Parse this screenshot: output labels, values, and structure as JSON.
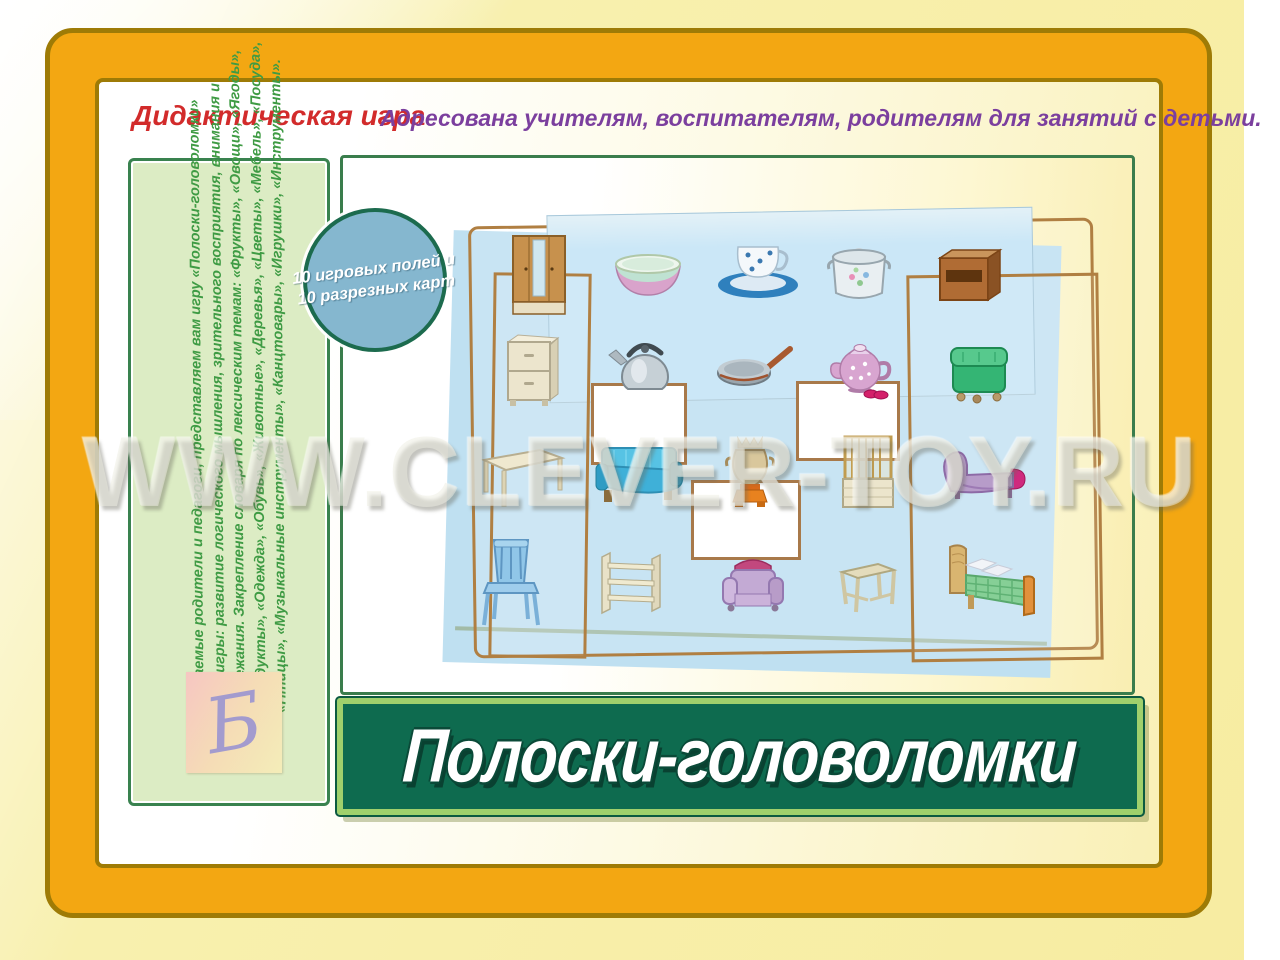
{
  "header": {
    "label": "Дидактическая игра",
    "audience": "Адресована учителям, воспитателям, родителям для занятий с детьми."
  },
  "sidebar": {
    "lines": [
      "Уважаемые родители и педагоги, представляем вам игру «Полоски-головоломки»",
      "Цель игры: развитие логического мышления, зрительного восприятия, внимания и",
      "прилежания. Закрепление словаря по лексическим темам: «Фрукты», «Овощи», «Ягоды»,",
      "«Продукты», «Одежда», «Обувь», «Животные», «Деревья», «Цветы», «Мебель», «Посуда»,",
      "«Птицы», «Музыкальные инструменты», «Канцтовары», «Игрушки», «Инструменты»."
    ]
  },
  "badge": {
    "line1": "10 игровых полей и",
    "line2": "10 разрезных карт"
  },
  "board": {
    "items": [
      "wardrobe",
      "bowl",
      "cup-and-saucer",
      "pot",
      "bedside-table",
      "dresser",
      "kettle",
      "frying-pan",
      "teapot",
      "pouf",
      "table",
      "sofa",
      "samovar",
      "crib",
      "chaise-lounge",
      "chair",
      "shelf",
      "armchair",
      "stool",
      "bed",
      "red-slippers"
    ]
  },
  "watermark": {
    "text": "WWW.CLEVER-TOY.RU"
  },
  "title": {
    "text": "Полоски-головоломки"
  },
  "logo": {
    "letter": "Б"
  },
  "colors": {
    "frame_gold": "#F3A712",
    "frame_border": "#9E7B06",
    "banner_green": "#0E6B4F",
    "banner_border": "#9FD06C",
    "board_blue": "#BFE0F1",
    "sidebar_green": "#DCECC4",
    "accent_red": "#D22B2B",
    "accent_purple": "#7B3F9E",
    "text_green": "#3F9B44",
    "badge_blue": "#85B7CF"
  }
}
